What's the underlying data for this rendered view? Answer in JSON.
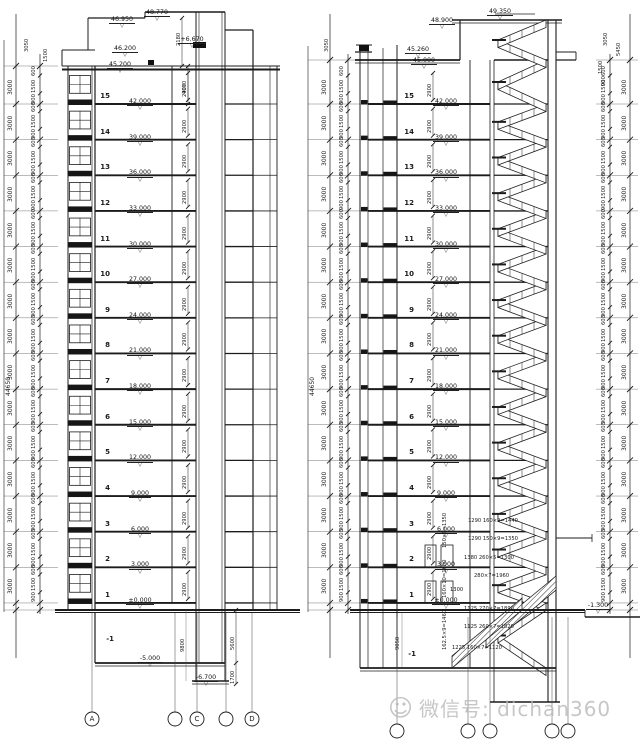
{
  "floors": [
    {
      "no": "15",
      "level": "42.000"
    },
    {
      "no": "14",
      "level": "39.000"
    },
    {
      "no": "13",
      "level": "36.000"
    },
    {
      "no": "12",
      "level": "33.000"
    },
    {
      "no": "11",
      "level": "30.000"
    },
    {
      "no": "10",
      "level": "27.000"
    },
    {
      "no": "9",
      "level": "24.000"
    },
    {
      "no": "8",
      "level": "21.000"
    },
    {
      "no": "7",
      "level": "18.000"
    },
    {
      "no": "6",
      "level": "15.000"
    },
    {
      "no": "5",
      "level": "12.000"
    },
    {
      "no": "4",
      "level": "9.000"
    },
    {
      "no": "3",
      "level": "6.000"
    },
    {
      "no": "2",
      "level": "3.000"
    },
    {
      "no": "1",
      "level": "±0.000"
    }
  ],
  "dims": {
    "floor": "3000",
    "sub_bottom": "900",
    "sub_mid": "1500",
    "sub_top": "600",
    "total": "44650",
    "top1": "3050",
    "top2": "5450",
    "top3": "1500",
    "top4": "900"
  },
  "left": {
    "grid": [
      "A",
      "",
      "C",
      "",
      "D"
    ],
    "levels": {
      "top": "48.770",
      "upper": "46.950",
      "machine": "+6.670",
      "parapet2": "46.200",
      "roof": "45.200"
    },
    "machine_dim": "2180",
    "roof_shaft_dim": "4070",
    "typ_shaft_dim": "2900",
    "basement_no": "-1",
    "basement_level": "-5.000",
    "pit_level": "-6.700",
    "pit_dim": "5600",
    "pit_depth_dim": "1700",
    "shaft_base_dim": "9800"
  },
  "right": {
    "levels": {
      "top": "49.350",
      "machine_roof": "48.900",
      "parapet": "45.260",
      "roof": "45.000"
    },
    "typ_shaft_dim": "2900",
    "basement_no": "-1",
    "basement_height_dim": "9050",
    "entrance_level": "-1.300",
    "stair_dims": [
      "1290  160×9=1440",
      "1290  150×9=1350",
      "1380  260×5=1300",
      "280×7=1960",
      "1300",
      "1125  270×7=1890",
      "1125  260×7=1820",
      "1225  160×7=1120"
    ],
    "stair_vdims": [
      "150×9=1350",
      "160×10=1600",
      "162.5×9=1460"
    ]
  },
  "icons": {
    "level_marker": "▽",
    "watermark_logo": "☺"
  },
  "watermark": {
    "text": "微信号: dichan360"
  }
}
